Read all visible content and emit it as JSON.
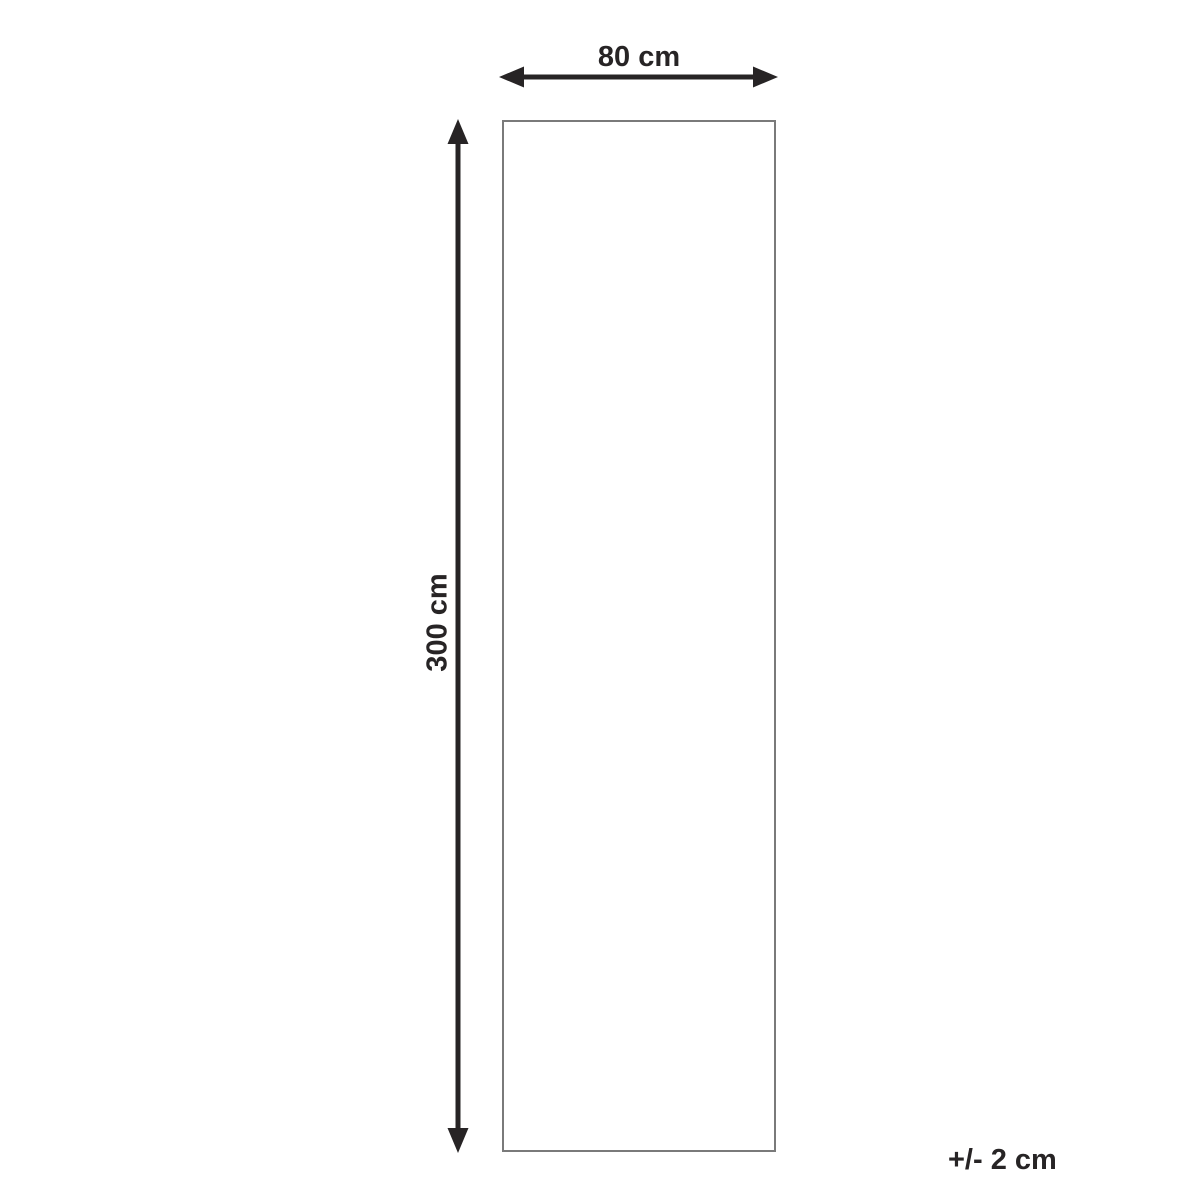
{
  "diagram": {
    "type": "product-dimension-diagram",
    "width_label": "80 cm",
    "height_label": "300 cm",
    "tolerance_label": "+/- 2 cm",
    "dimensions": {
      "width_cm": 80,
      "height_cm": 300,
      "tolerance_cm": 2
    },
    "colors": {
      "arrow_and_text": "#272425",
      "outline": "#7a7a7a",
      "background": "#ffffff"
    }
  }
}
